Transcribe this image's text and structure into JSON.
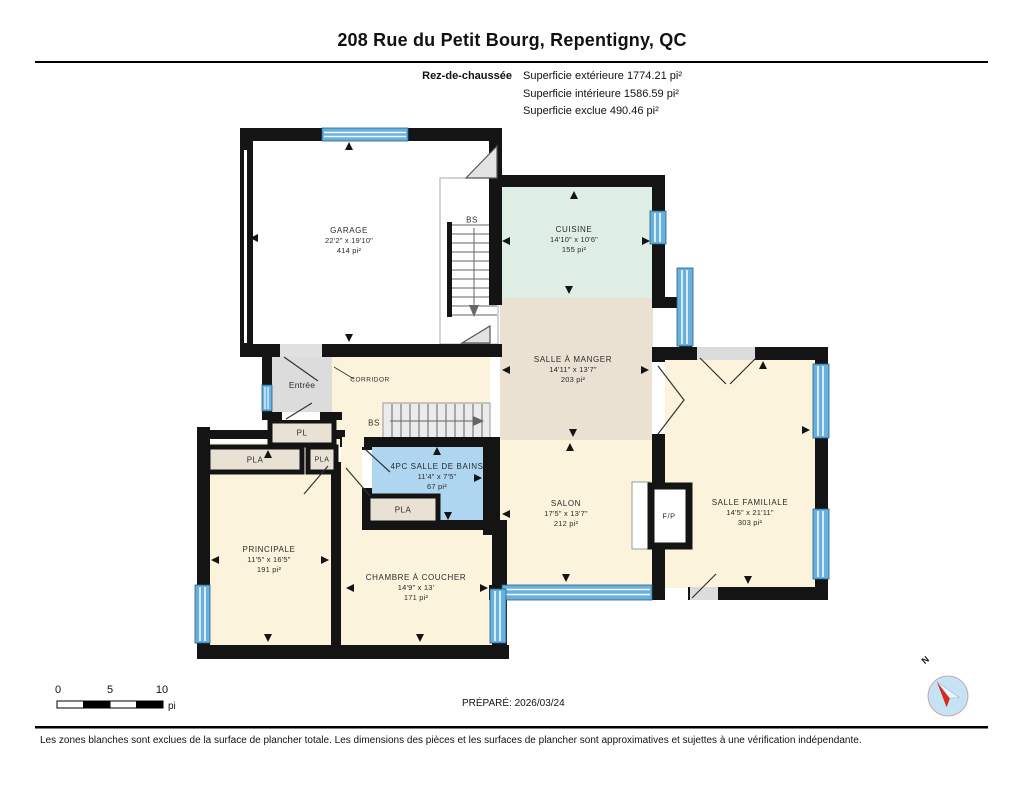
{
  "header": {
    "title": "208 Rue du Petit Bourg, Repentigny, QC",
    "floor_label": "Rez-de-chaussée",
    "stats": [
      "Superficie extérieure 1774.21 pi²",
      "Superficie intérieure 1586.59 pi²",
      "Superficie exclue 490.46 pi²"
    ]
  },
  "rooms": {
    "garage": {
      "name": "GARAGE",
      "dims": "22'2\" x 19'10\"",
      "area": "414 pi²"
    },
    "cuisine": {
      "name": "CUISINE",
      "dims": "14'10\" x 10'6\"",
      "area": "155 pi²"
    },
    "salle_a_manger": {
      "name": "SALLE À MANGER",
      "dims": "14'11\" x 13'7\"",
      "area": "203 pi²"
    },
    "salon": {
      "name": "SALON",
      "dims": "17'5\" x 13'7\"",
      "area": "212 pi²"
    },
    "salle_familiale": {
      "name": "SALLE FAMILIALE",
      "dims": "14'5\" x 21'11\"",
      "area": "303 pi²"
    },
    "salle_de_bains": {
      "name": "4PC SALLE DE BAINS",
      "dims": "11'4\" x 7'5\"",
      "area": "67 pi²"
    },
    "principale": {
      "name": "PRINCIPALE",
      "dims": "11'5\" x 16'5\"",
      "area": "191 pi²"
    },
    "chambre": {
      "name": "CHAMBRE À COUCHER",
      "dims": "14'9\" x 13'",
      "area": "171 pi²"
    }
  },
  "small_labels": {
    "entree": "Entrée",
    "corridor": "CORRIDOR",
    "pl": "PL",
    "pla_left": "PLA",
    "pla_hall": "PLA",
    "pla_bath": "PLA",
    "bs_garage": "BS",
    "bs_hall": "BS",
    "fireplace": "F/P",
    "north": "N"
  },
  "scale_bar": {
    "ticks": [
      "0",
      "5",
      "10"
    ],
    "unit": "pi"
  },
  "footer": {
    "prepared": "PRÉPARÉ: 2026/03/24",
    "disclaimer": "Les zones blanches sont exclues de la surface de plancher totale. Les dimensions des pièces et les surfaces de plancher sont approximatives et sujettes à une vérification indépendante."
  },
  "colors": {
    "wall": "#141414",
    "window_blue": "#68B1DF",
    "room_cream": "#FBF3DC",
    "room_beige": "#EAE1D2",
    "room_mint": "#DFEEE5",
    "room_bath_blue": "#AED6F1",
    "closet_tan": "#E9E2D4",
    "entry_gray": "#DCDCDC",
    "compass_red": "#D42A1E"
  }
}
